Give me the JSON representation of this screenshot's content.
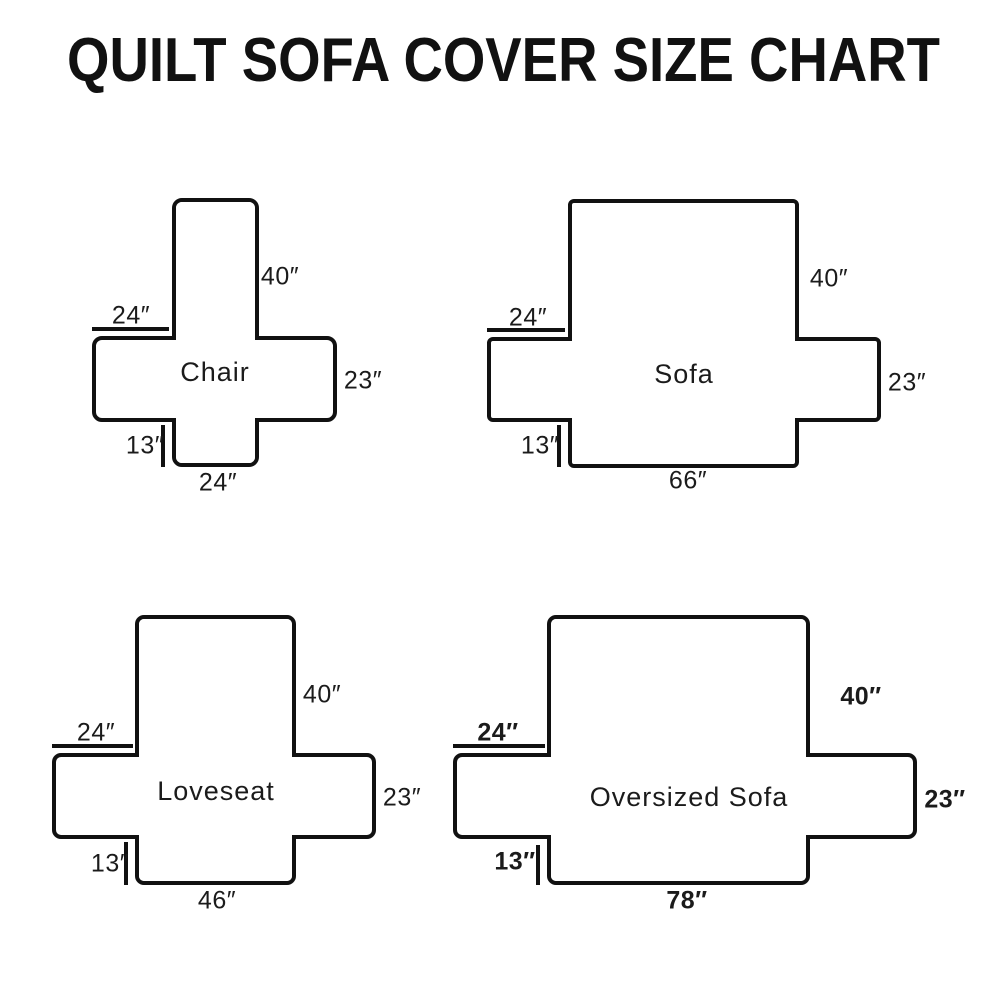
{
  "title": "QUILT SOFA COVER SIZE CHART",
  "colors": {
    "line": "#111111",
    "text": "#1b1b1b",
    "background": "#ffffff"
  },
  "diagrams": {
    "chair": {
      "label": "Chair",
      "back_height": "40″",
      "arm_width": "24″",
      "arm_depth": "23″",
      "front_drop": "13″",
      "seat_width": "24″"
    },
    "sofa": {
      "label": "Sofa",
      "back_height": "40″",
      "arm_width": "24″",
      "arm_depth": "23″",
      "front_drop": "13″",
      "seat_width": "66″"
    },
    "loveseat": {
      "label": "Loveseat",
      "back_height": "40″",
      "arm_width": "24″",
      "arm_depth": "23″",
      "front_drop": "13″",
      "seat_width": "46″"
    },
    "oversized": {
      "label": "Oversized Sofa",
      "back_height": "40″",
      "arm_width": "24″",
      "arm_depth": "23″",
      "front_drop": "13″",
      "seat_width": "78″"
    }
  }
}
